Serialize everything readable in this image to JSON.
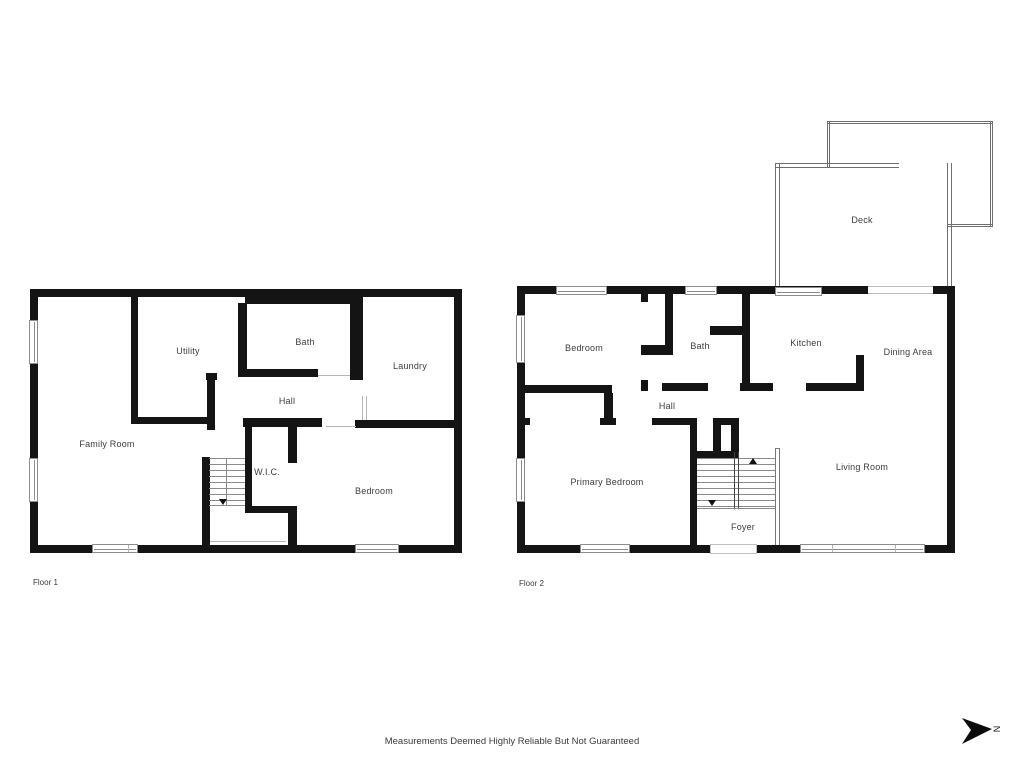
{
  "page": {
    "disclaimer": "Measurements Deemed Highly Reliable But Not Guaranteed",
    "background": "#ffffff"
  },
  "colors": {
    "wall": "#141414",
    "label_text": "#3d3d3d",
    "window_outline": "#8c8c8c",
    "deck_outline": "#6e6e6e",
    "stair_tread": "#8a8a8a"
  },
  "north_indicator": {
    "label": "N"
  },
  "floor1": {
    "caption": "Floor 1",
    "rooms": [
      {
        "label": "Family Room"
      },
      {
        "label": "Utility"
      },
      {
        "label": "Bath"
      },
      {
        "label": "Laundry"
      },
      {
        "label": "Hall"
      },
      {
        "label": "W.I.C."
      },
      {
        "label": "Bedroom"
      }
    ]
  },
  "floor2": {
    "caption": "Floor 2",
    "rooms": [
      {
        "label": "Bedroom"
      },
      {
        "label": "Bath"
      },
      {
        "label": "Kitchen"
      },
      {
        "label": "Dining Area"
      },
      {
        "label": "Hall"
      },
      {
        "label": "Primary Bedroom"
      },
      {
        "label": "Foyer"
      },
      {
        "label": "Living Room"
      },
      {
        "label": "Deck"
      }
    ]
  }
}
